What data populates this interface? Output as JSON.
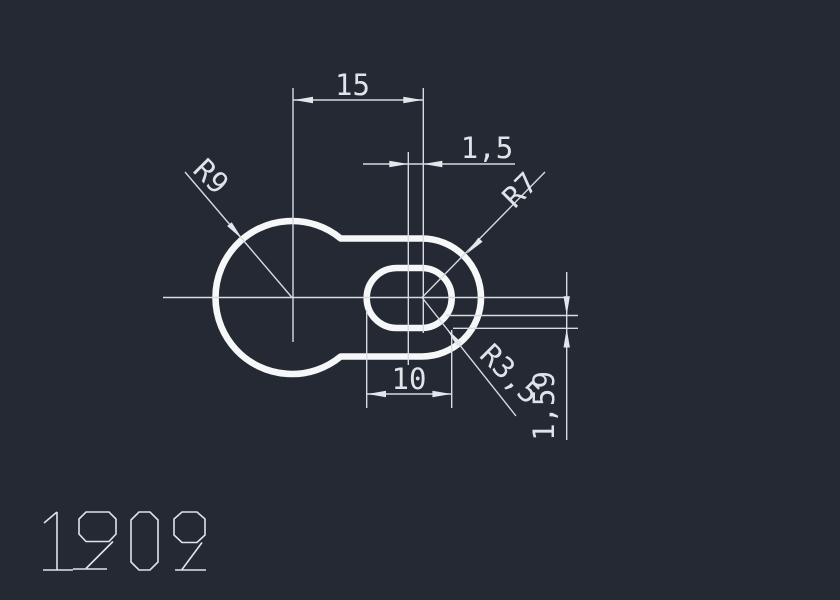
{
  "viewport": {
    "background": "#242933",
    "geometry_color": "#f5f7f8",
    "annotation_color": "#d5dbe0"
  },
  "drawing": {
    "part_number": "1909",
    "dimensions": {
      "center_distance": "15",
      "slot_offset": "1,5",
      "slot_width": "10",
      "vertical_dim": "1,59"
    },
    "radii": {
      "outer_large": "R9",
      "outer_small": "R7",
      "slot_corner": "R3,5"
    }
  }
}
